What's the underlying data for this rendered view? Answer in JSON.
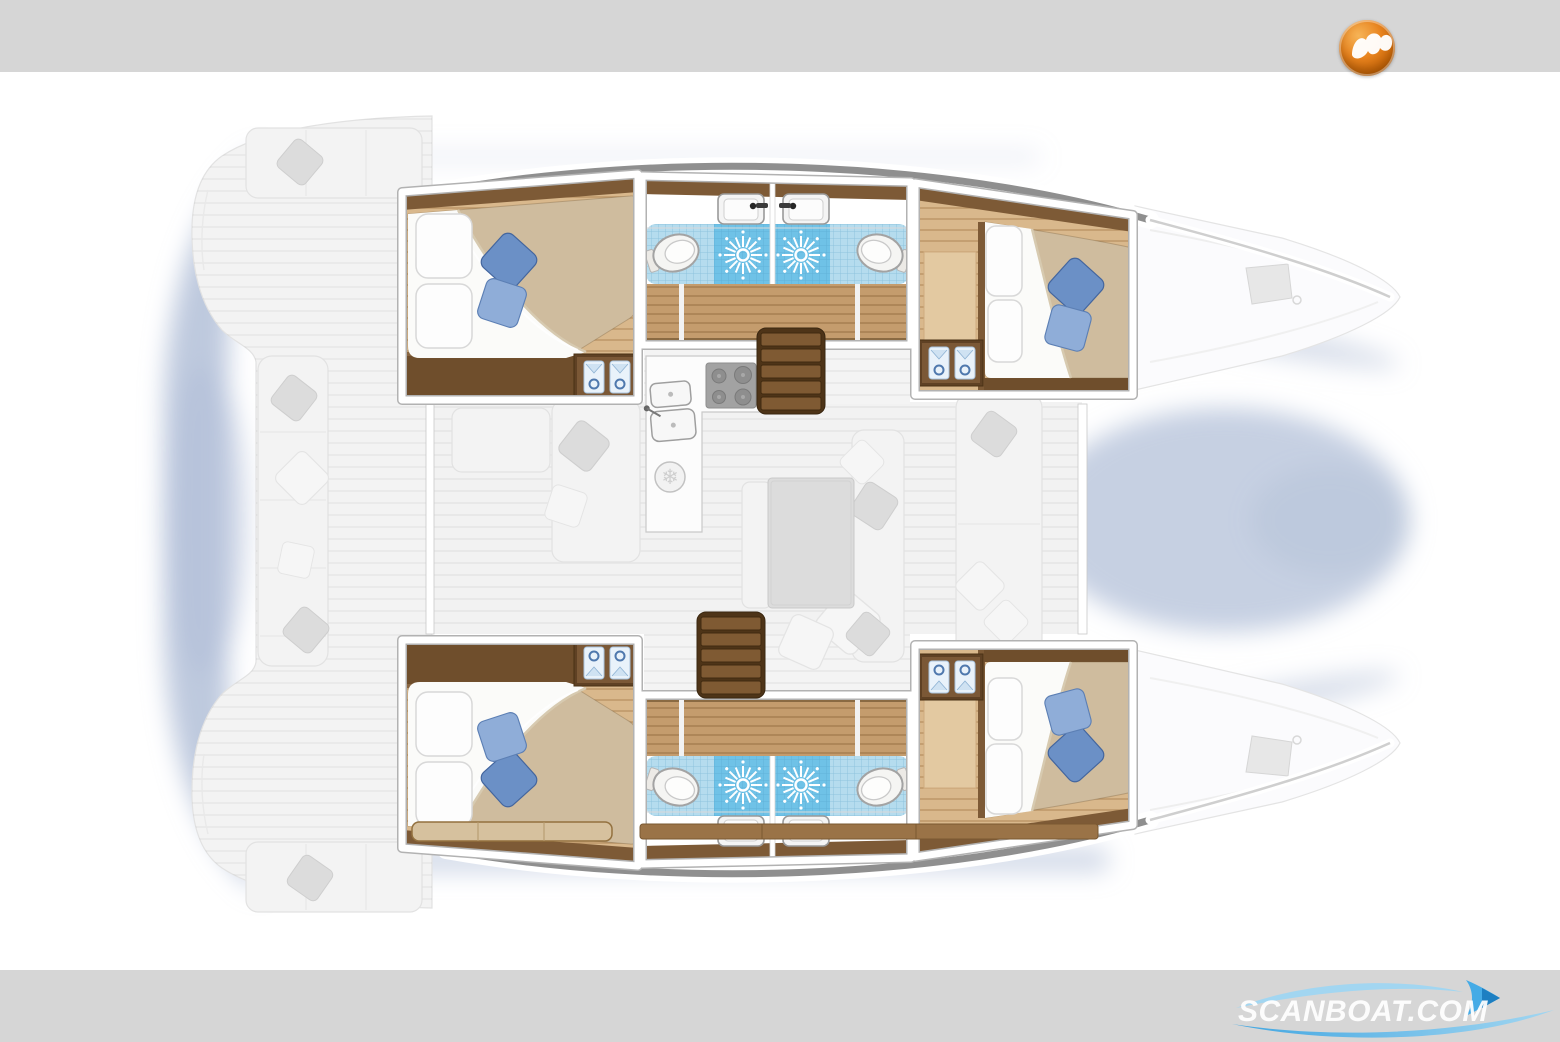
{
  "page": {
    "width": 1560,
    "height": 1040,
    "background": "#ffffff"
  },
  "brand": {
    "logo_icon": "scanboat-orb-logo",
    "watermark_text": "SCANBOAT.COM",
    "watermark_icons": [
      "wave-swoosh-icon",
      "sail-icon"
    ]
  },
  "colors": {
    "band": "#d6d6d6",
    "brand_orange": "#e8831e",
    "wave_blue": "#3aa4e2",
    "wave_blue_light": "#9fd6f2",
    "watermark_text": "#ffffff",
    "shadow": "#b3c0d8",
    "ghost": "#f3f3f3",
    "ghost_line": "#e2e2e2",
    "wall_white": "#ffffff",
    "wall_edge": "#b2b2b2",
    "window_strip": "#8f8f8f",
    "wood_trim": "#6f4e2c",
    "wood_trim_light": "#7d5a36",
    "wood_floor": "#d9b88c",
    "corridor": "#c49c6d",
    "duvet": "#cfbc9e",
    "sheet": "#fbfbf9",
    "pillow_blue": "#6b90c6",
    "pillow_blue_light": "#8fadd8",
    "tile": "#b5dcee",
    "shower": "#6fc2e7",
    "toilet": "#f5f5f3",
    "stair_dark": "#4e3418",
    "stair_step": "#7f5a33",
    "stove": "#a2a2a2",
    "shirt_blue": "#e9f2fa"
  },
  "floorplan": {
    "type": "catamaran-deck-plan",
    "orientation": "bow-right",
    "rooms": [
      "cabin-port-aft",
      "head-port-aft",
      "head-port-fwd",
      "cabin-port-fwd",
      "cabin-stbd-aft",
      "head-stbd-aft",
      "head-stbd-fwd",
      "cabin-stbd-fwd",
      "saloon",
      "galley",
      "aft-cockpit",
      "foredeck"
    ],
    "features": {
      "double_cabins": 4,
      "heads": 4,
      "toilets": 4,
      "showers": 4,
      "wash_basins": 4,
      "wardrobes": 4,
      "companionway_stairs": 2,
      "galley": {
        "burners": 4,
        "sinks": 2,
        "fridge": 1
      },
      "saloon": {
        "table": 1,
        "sofas": true
      },
      "aft_cockpit_bench": true,
      "fore_cockpit_bench": true
    }
  }
}
